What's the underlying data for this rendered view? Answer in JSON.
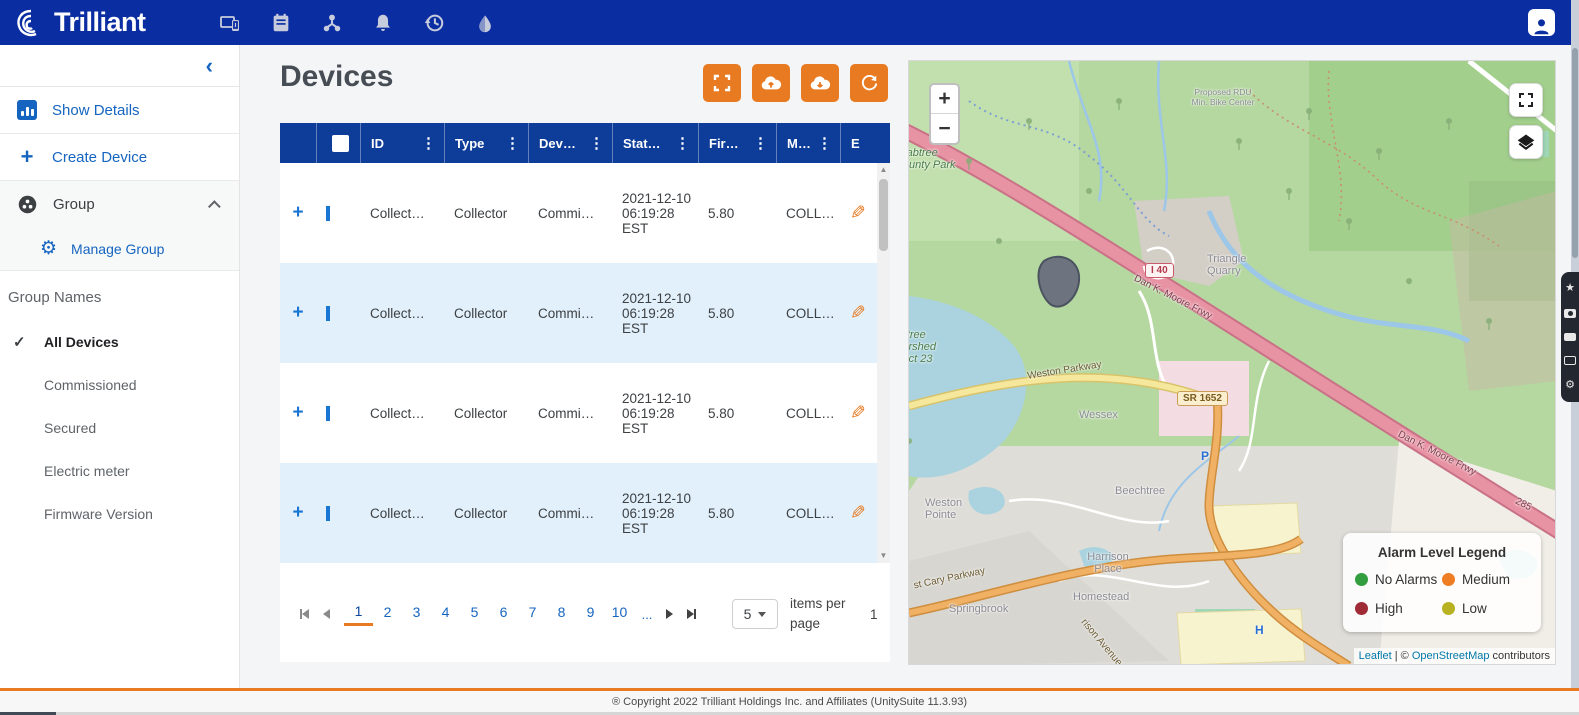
{
  "theme": {
    "navbar": "#0b2da2",
    "table_header": "#0d3d99",
    "accent_orange": "#e87a22",
    "link_blue": "#1565c0"
  },
  "nav": {
    "brand": "Trilliant"
  },
  "sidebar": {
    "collapse": "‹",
    "show_details": "Show Details",
    "create_device": "Create Device",
    "group": "Group",
    "manage_group": "Manage Group",
    "group_names_header": "Group Names",
    "groups": [
      {
        "label": "All Devices",
        "selected": true,
        "check": "✓"
      },
      {
        "label": "Commissioned",
        "selected": false
      },
      {
        "label": "Secured",
        "selected": false
      },
      {
        "label": "Electric meter",
        "selected": false
      },
      {
        "label": "Firmware Version",
        "selected": false
      }
    ]
  },
  "devices": {
    "title": "Devices"
  },
  "table": {
    "columns": [
      "ID",
      "Type",
      "Dev…",
      "Stat…",
      "Fir…",
      "M…",
      "E"
    ],
    "kebab": "⋮",
    "expand": "+",
    "edit_icon": "✎",
    "rows": [
      {
        "id": "Collect…",
        "type": "Collector",
        "dev": "Commi…",
        "stat": "2021-12-10 06:19:28 EST",
        "fir": "5.80",
        "m": "COLL…"
      },
      {
        "id": "Collect…",
        "type": "Collector",
        "dev": "Commi…",
        "stat": "2021-12-10 06:19:28 EST",
        "fir": "5.80",
        "m": "COLL…"
      },
      {
        "id": "Collect…",
        "type": "Collector",
        "dev": "Commi…",
        "stat": "2021-12-10 06:19:28 EST",
        "fir": "5.80",
        "m": "COLL…"
      },
      {
        "id": "Collect…",
        "type": "Collector",
        "dev": "Commi…",
        "stat": "2021-12-10 06:19:28 EST",
        "fir": "5.80",
        "m": "COLL…"
      }
    ]
  },
  "pagination": {
    "pages": [
      "1",
      "2",
      "3",
      "4",
      "5",
      "6",
      "7",
      "8",
      "9",
      "10"
    ],
    "ellipsis": "...",
    "current_page": "1",
    "page_size": "5",
    "items_per_page": "items per page",
    "overflow": "1"
  },
  "map": {
    "zoom_in": "+",
    "zoom_out": "−",
    "legend": {
      "title": "Alarm Level Legend",
      "items": [
        {
          "label": "No Alarms",
          "color": "#339e3f"
        },
        {
          "label": "Medium",
          "color": "#ee7d23"
        },
        {
          "label": "High",
          "color": "#9e2b35"
        },
        {
          "label": "Low",
          "color": "#b8b222"
        }
      ]
    },
    "attribution": {
      "leaflet": "Leaflet",
      "separator": " | © ",
      "osm": "OpenStreetMap",
      "suffix": " contributors"
    },
    "labels": {
      "crabtree_park": "Crabtree County Park",
      "watershed": "Crabtree Watershed Project 23",
      "proposed": "Proposed RDU Min. Bike Center",
      "quarry": "Triangle Quarry",
      "wessex": "Wessex",
      "beechtree": "Beechtree",
      "weston_pointe": "Weston Pointe",
      "harrison_place": "Harrison Place",
      "homestead": "Homestead",
      "springbrook": "Springbrook",
      "weston_parkway": "Weston Parkway",
      "cary_parkway": "st Cary Parkway",
      "harrison_avenue": "rison Avenue",
      "dan_k_moore": "Dan K. Moore Frwy",
      "shield_i40": "I 40",
      "shield_sr1652": "SR 1652",
      "route_285": "285",
      "parking": "P",
      "hospital": "H"
    }
  },
  "footer": {
    "text": "® Copyright 2022 Trilliant Holdings Inc. and Affiliates (UnitySuite 11.3.93)"
  }
}
